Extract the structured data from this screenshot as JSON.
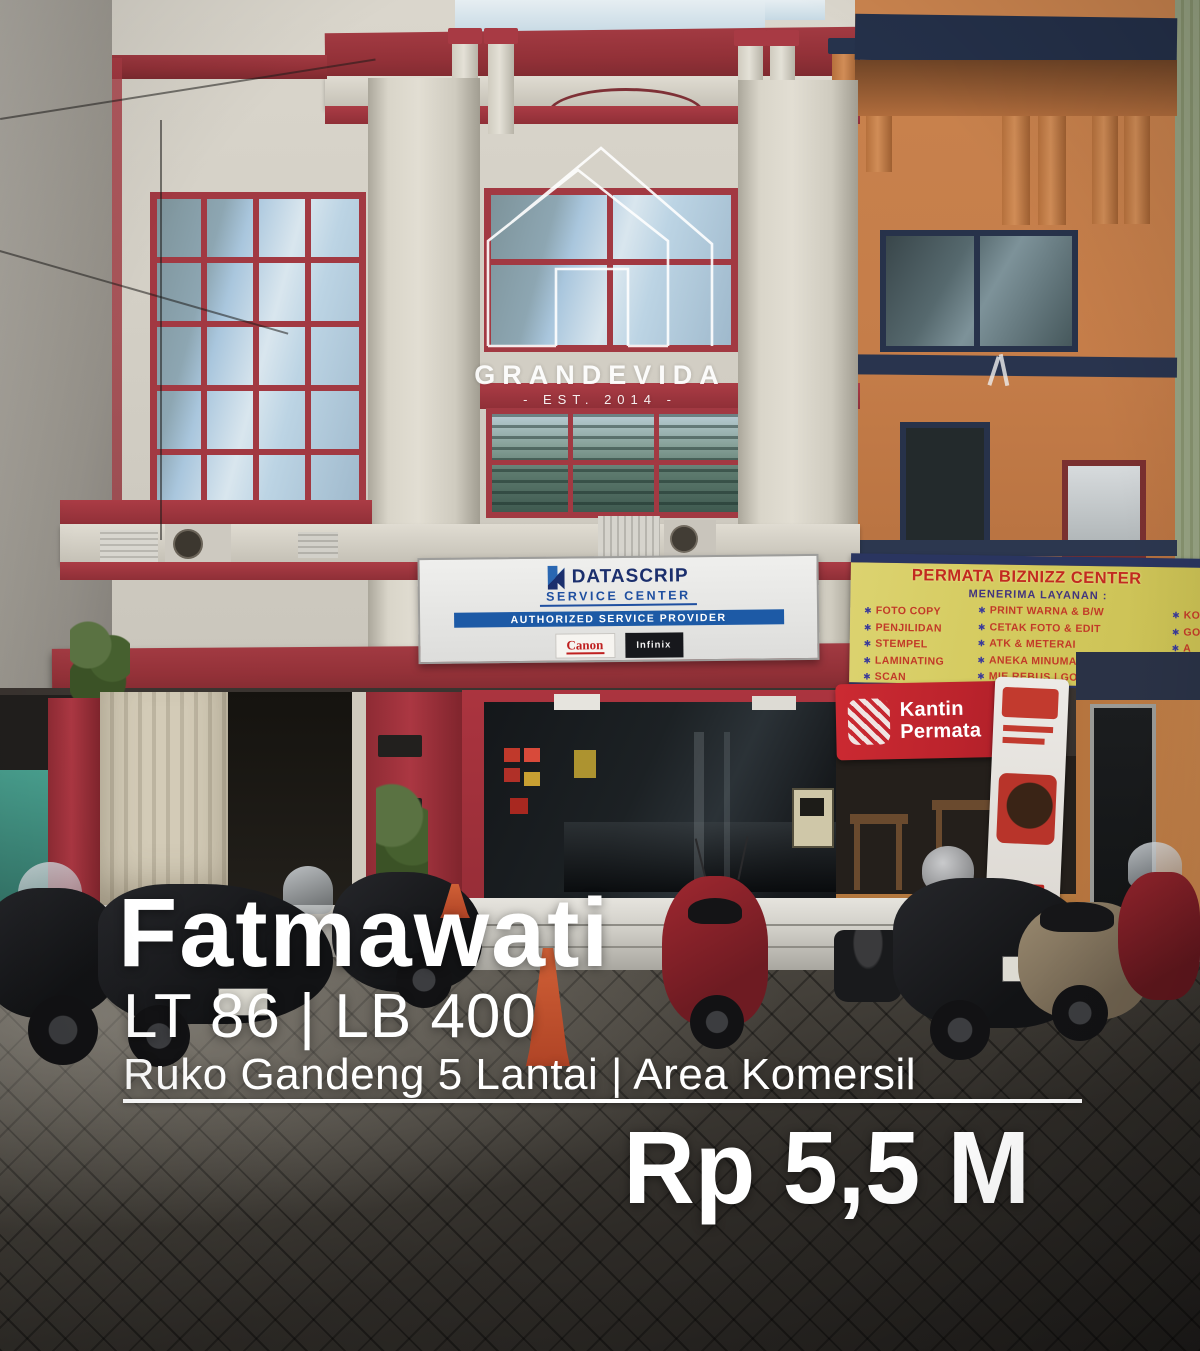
{
  "watermark": {
    "brand": "GRANDEVIDA",
    "established": "- EST. 2014 -"
  },
  "signs": {
    "datascrip": {
      "brand": "DATASCRIP",
      "subtitle": "SERVICE CENTER",
      "banner": "AUTHORIZED SERVICE PROVIDER",
      "partner_canon": "Canon",
      "partner_infinix": "Infinix"
    },
    "permata": {
      "title": "PERMATA BIZNIZZ CENTER",
      "subtitle": "MENERIMA LAYANAN :",
      "bullet": "✱",
      "col1": [
        "FOTO COPY",
        "PENJILIDAN",
        "STEMPEL",
        "LAMINATING",
        "SCAN"
      ],
      "col2": [
        "PRINT WARNA & B/W",
        "CETAK FOTO & EDIT",
        "ATK & METERAI",
        "ANEKA MINUMAN DINGIN",
        "MIE REBUS | GORENG"
      ],
      "col3": [
        "KO",
        "GO",
        "A",
        "A",
        "E"
      ]
    },
    "kantin": {
      "line1": "Kantin",
      "line2": "Permata"
    }
  },
  "caption": {
    "location": "Fatmawati",
    "specs": "LT 86 | LB 400",
    "category": "Ruko Gandeng 5 Lantai | Area Komersil",
    "price": "Rp 5,5 M"
  },
  "colors": {
    "trim_red": "#a23942",
    "facade_cream": "#d6d2c8",
    "facade_orange": "#c8814c",
    "banner_yellow": "#d5cb60",
    "banner_navy": "#2a3560",
    "kantin_red": "#c2252e",
    "datascrip_blue": "#1d5aa6",
    "overlay_white": "#ffffff",
    "paving_dark": "#2e2b27"
  }
}
